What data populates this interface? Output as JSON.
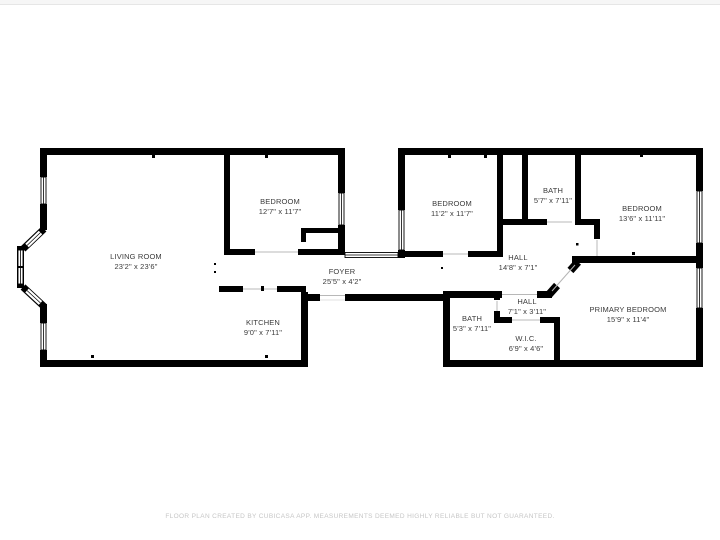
{
  "colors": {
    "wall": "#000000",
    "room_label": "#3b3b3b",
    "disclaimer_text": "#c6c6c6"
  },
  "rooms": [
    {
      "name": "LIVING ROOM",
      "dims": "23'2\" x 23'6\""
    },
    {
      "name": "BEDROOM",
      "dims": "12'7\" x 11'7\""
    },
    {
      "name": "KITCHEN",
      "dims": "9'0\" x 7'11\""
    },
    {
      "name": "FOYER",
      "dims": "25'5\" x 4'2\""
    },
    {
      "name": "BEDROOM",
      "dims": "11'2\" x 11'7\""
    },
    {
      "name": "BATH",
      "dims": "5'7\" x 7'11\""
    },
    {
      "name": "BEDROOM",
      "dims": "13'6\" x 11'11\""
    },
    {
      "name": "HALL",
      "dims": "14'8\" x 7'1\""
    },
    {
      "name": "HALL",
      "dims": "7'1\" x 3'11\""
    },
    {
      "name": "BATH",
      "dims": "5'3\" x 7'11\""
    },
    {
      "name": "W.I.C.",
      "dims": "6'9\" x 4'6\""
    },
    {
      "name": "PRIMARY BEDROOM",
      "dims": "15'9\" x 11'4\""
    }
  ],
  "footer": {
    "text": "FLOOR PLAN CREATED BY CUBICASA APP. MEASUREMENTS DEEMED HIGHLY RELIABLE BUT NOT GUARANTEED."
  }
}
